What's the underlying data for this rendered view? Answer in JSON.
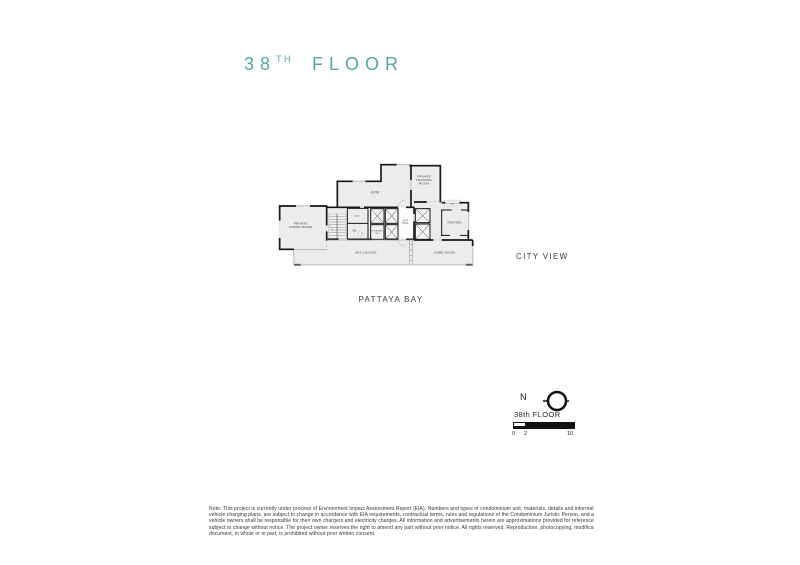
{
  "title": {
    "number": "38",
    "ordinal": "TH",
    "word": "FLOOR"
  },
  "plan": {
    "dining_l1": "PRIVATE",
    "dining_l2": "DINING ROOM",
    "gym": "GYM",
    "training_l1": "PRIVATE",
    "training_l2": "TRAINING",
    "training_l3": "ROOM",
    "theater": "THEATER",
    "game_room": "GAME ROOM",
    "sky_lounge": "SKY LOUNGE",
    "lift_hall_l1": "LIFT",
    "lift_hall_l2": "HALL",
    "fireman_l1": "FIREMAN",
    "fireman_l2": "LIFT",
    "st": "ST",
    "gb": "GB",
    "cw": "CW"
  },
  "views": {
    "city": "CITY VIEW",
    "bay": "PATTAYA BAY"
  },
  "compass": {
    "north": "N"
  },
  "legend": {
    "floor_label": "38th FLOOR",
    "ticks": [
      "0",
      "2",
      "10"
    ]
  },
  "note_lines": [
    "Note: This project is currently under process of Environment Impact Assessment Report (EIA). Numbers and types of condominium unit, materials, details and information about the Project, including electric",
    "vehicle charging plans, are subject to change in accordance with EIA requirements, contractual terms, rules and regulations of the Condominium Juristic Person, and applicable fees, without prior notice. Electric",
    "vehicle owners shall be responsible for their own chargers and electricity charges. All information and advertisements herein are approximations provided for reference only. This document is a draft and remains",
    "subject to change without notice. The project owner reserves the right to amend any part without prior notice. All rights reserved. Reproduction, photocopying, modification, alteration, or publishing of this",
    "document, in whole or in part, is prohibited without prior written consent."
  ],
  "colors": {
    "accent": "#55A6A6",
    "wall": "#161616",
    "room_fill": "#ECECEA",
    "text": "#3D3D3C"
  }
}
